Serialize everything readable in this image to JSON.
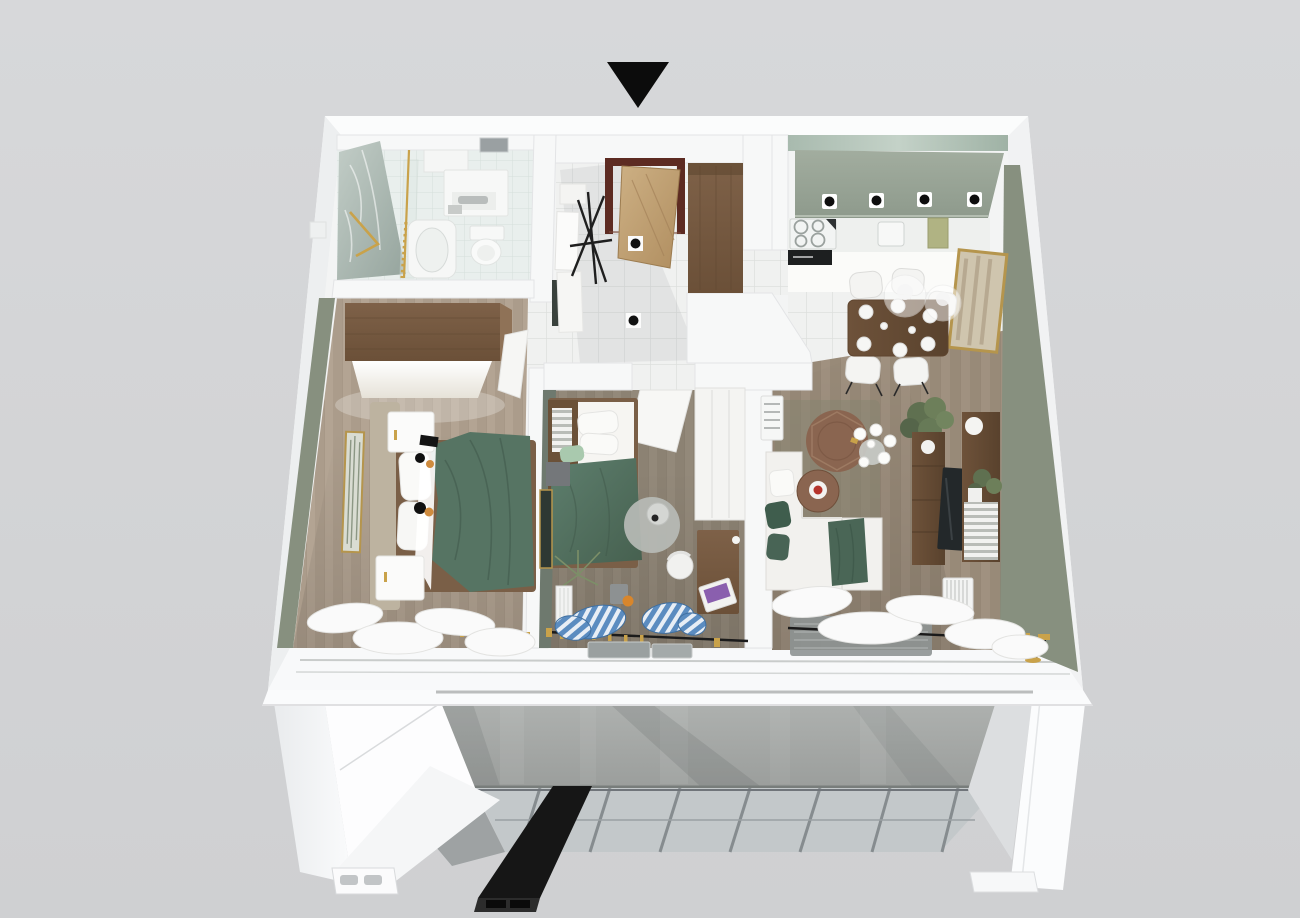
{
  "scene": {
    "type": "3d-floor-plan-cutaway-render",
    "view": "top-down-axonometric",
    "entrance_marker": "black-triangle-arrow",
    "building_below": [
      "concrete-wall",
      "glass-panel-grid",
      "black-beam",
      "white-piers",
      "floor-slab"
    ]
  },
  "palette": {
    "background": "#d3d4d6",
    "wall_white": "#f6f7f8",
    "wall_top": "#f3f4f4",
    "wall_green": "#87907f",
    "wall_green_dark": "#6e796e",
    "floor_master": "#b3a493",
    "floor_mid": "#93897a",
    "floor_living": "#a09180",
    "tile_white": "#f0f1f0",
    "tile_bath": "#e9efed",
    "marble": "#b9c4be",
    "bulkhead_sage": "#99a496",
    "duvet_teal": "#567463",
    "wood_furniture": "#7c5f44",
    "wood_dark": "#6e523a",
    "wood_door": "#c3a277",
    "door_frame": "#5d2b22",
    "curtain_blue": "#5b8cc0",
    "gold": "#c9a24a",
    "concrete": "#a6a9a7",
    "panel_grid": "#c3c8ca",
    "beam_black": "#161616",
    "marker_black": "#0c0c0c",
    "sofa_white": "#f2f1ee",
    "pillow_green": "#3f5d4d",
    "accent_red": "#b5342c",
    "accent_orange": "#d8862c",
    "screen_purple": "#8a5fae",
    "radiator_white": "#f3f4f3",
    "rug_grey": "#8e9493"
  },
  "rooms": [
    {
      "id": "bathroom",
      "items": [
        "marble-wall",
        "shower-gold-rod",
        "bathtub",
        "toilet",
        "vanity-cabinet",
        "gold-towel-rail",
        "wall-niche"
      ]
    },
    {
      "id": "entrance-hall",
      "items": [
        "entry-door-frame",
        "open-wood-door",
        "coat-rack",
        "hall-wardrobe",
        "mirror-panels",
        "floor-spotlights"
      ]
    },
    {
      "id": "kitchen-dining",
      "items": [
        "sage-bulkhead",
        "ceiling-spotlights",
        "cooktop",
        "oven",
        "sink",
        "counter",
        "dining-table",
        "chairs",
        "pendant-lamps",
        "wall-art"
      ]
    },
    {
      "id": "master-bedroom",
      "items": [
        "wardrobe",
        "double-bed",
        "teal-duvet",
        "nightstands",
        "wall-art",
        "sheer-curtains",
        "curtain-rod"
      ]
    },
    {
      "id": "second-bedroom",
      "items": [
        "single-bed",
        "bookshelf-headboard",
        "white-wardrobe",
        "open-door",
        "round-rug",
        "floor-lamp",
        "desk",
        "laptop",
        "desk-chair",
        "radiator",
        "blue-striped-curtains",
        "plant",
        "orange-ball"
      ]
    },
    {
      "id": "living-room",
      "items": [
        "corner-sofa",
        "green-pillows",
        "coffee-table",
        "side-table",
        "cups",
        "plants",
        "tv-console",
        "tv",
        "shelf-unit",
        "books",
        "sphere-lamp",
        "radiator",
        "air-conditioner",
        "grey-rug",
        "sheer-curtains",
        "curtain-rod"
      ]
    }
  ]
}
